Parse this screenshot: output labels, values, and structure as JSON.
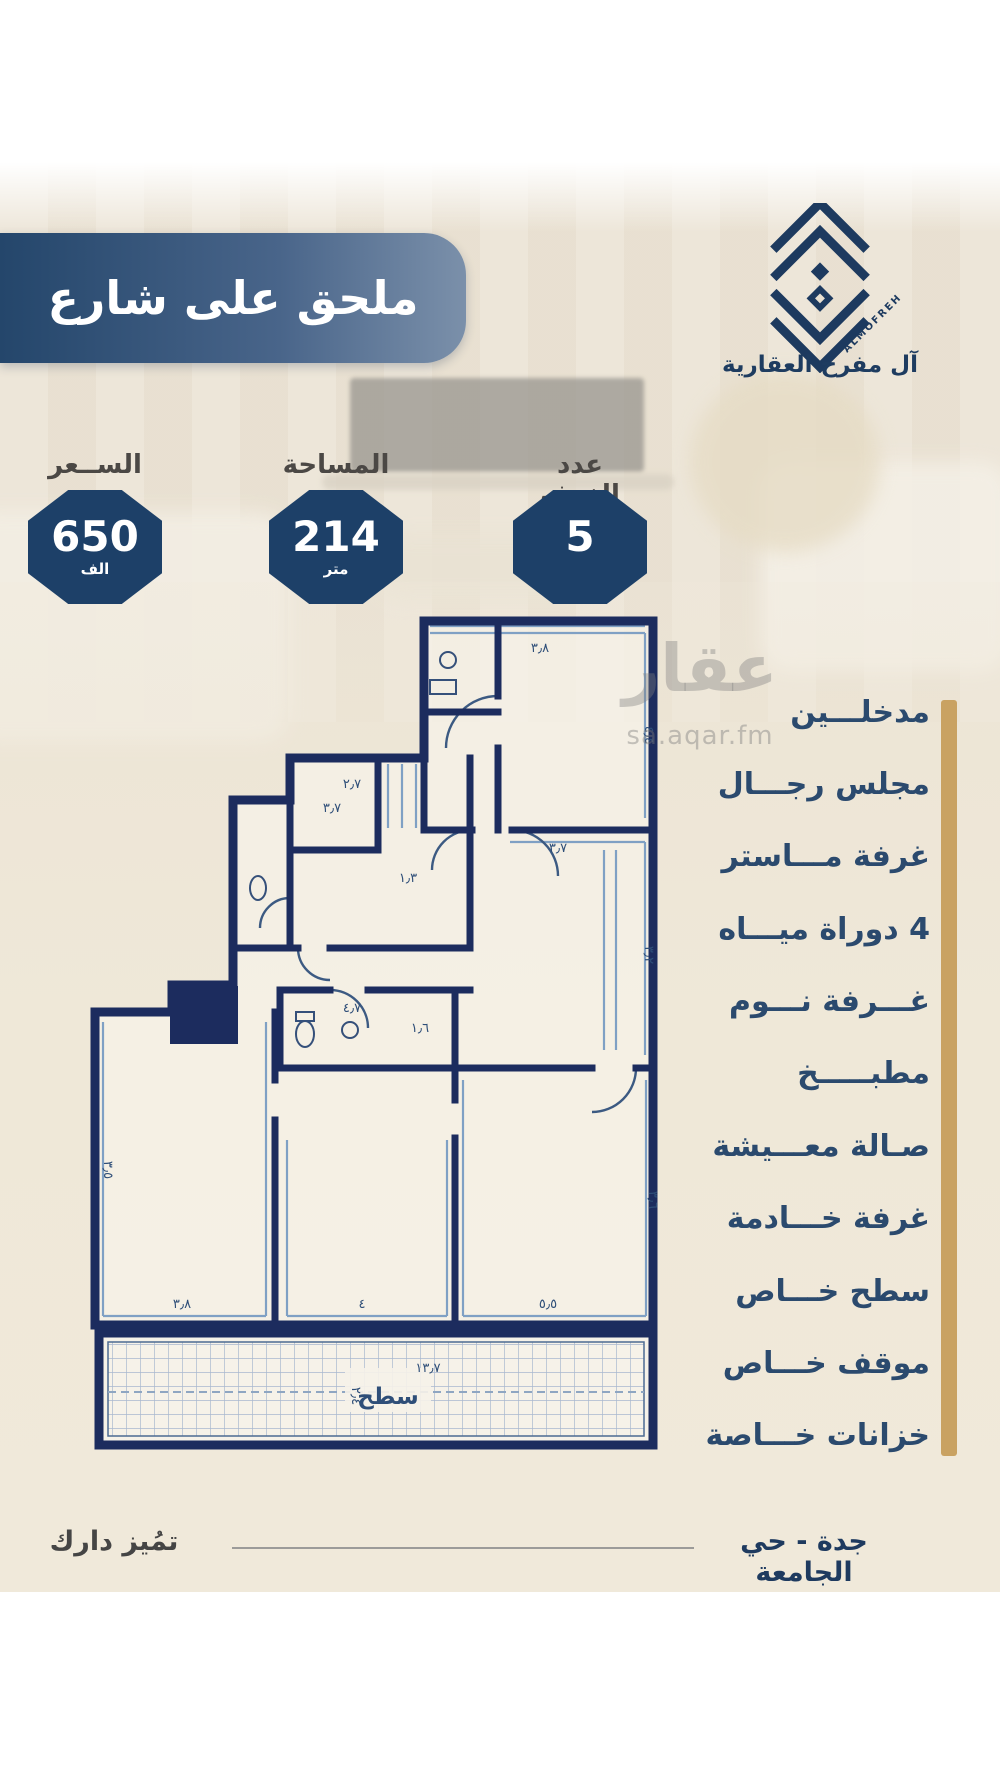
{
  "banner": {
    "title": "ملحق على شارع"
  },
  "brand": {
    "logo_text": "ALMOFREH",
    "company": "آل مفرح العقارية"
  },
  "stats": [
    {
      "label": "الســعر",
      "value": "650",
      "unit": "الف"
    },
    {
      "label": "المساحة",
      "value": "214",
      "unit": "متر"
    },
    {
      "label": "عدد الغرف",
      "value": "5",
      "unit": ""
    }
  ],
  "features": [
    "مدخلـــين",
    "مجلس رجـــال",
    "غرفة مـــاستر",
    "4 دوراة ميـــاه",
    "غـــرفة نـــوم",
    "مطبـــــخ",
    "صـالة معـــيشة",
    "غرفة خـــادمة",
    "سطح خـــاص",
    "موقف خـــاص",
    "خزانات خـــاصة"
  ],
  "floorplan": {
    "roof_label": "سطح",
    "dimensions": [
      {
        "t": "٣٫٨",
        "x": 540,
        "y": 652,
        "r": 0
      },
      {
        "t": "٤٫٤",
        "x": 645,
        "y": 735,
        "r": 90
      },
      {
        "t": "٢٫٧",
        "x": 352,
        "y": 788,
        "r": 0
      },
      {
        "t": "٣٫٧",
        "x": 332,
        "y": 812,
        "r": 0
      },
      {
        "t": "١٫٣",
        "x": 408,
        "y": 882,
        "r": 0
      },
      {
        "t": "٣٫٧",
        "x": 558,
        "y": 852,
        "r": 0
      },
      {
        "t": "٣٫٢",
        "x": 645,
        "y": 955,
        "r": 90
      },
      {
        "t": "٤٫٧",
        "x": 352,
        "y": 1012,
        "r": 0
      },
      {
        "t": "١٫٦",
        "x": 420,
        "y": 1032,
        "r": 0
      },
      {
        "t": "٣٫٥",
        "x": 104,
        "y": 1170,
        "r": 90
      },
      {
        "t": "٣٫٨",
        "x": 182,
        "y": 1308,
        "r": 0
      },
      {
        "t": "٤",
        "x": 362,
        "y": 1308,
        "r": 0
      },
      {
        "t": "٥٫٥",
        "x": 548,
        "y": 1308,
        "r": 0
      },
      {
        "t": "٣٫٦",
        "x": 649,
        "y": 1200,
        "r": 90
      },
      {
        "t": "١٣٫٧",
        "x": 428,
        "y": 1372,
        "r": 0
      },
      {
        "t": "٢٫٤",
        "x": 352,
        "y": 1396,
        "r": 90
      }
    ]
  },
  "watermark": {
    "name": "عقار",
    "site": "sa.aqar.fm"
  },
  "footer": {
    "location": "جدة - حي الجامعة",
    "slogan": "تمُيز دارك"
  },
  "colors": {
    "navy": "#1d4068",
    "wall": "#1c2c5e",
    "tan": "#c9a262",
    "feature_text": "#2b4a6e",
    "banner_left": "#24466b",
    "banner_right": "#7b90aa"
  }
}
